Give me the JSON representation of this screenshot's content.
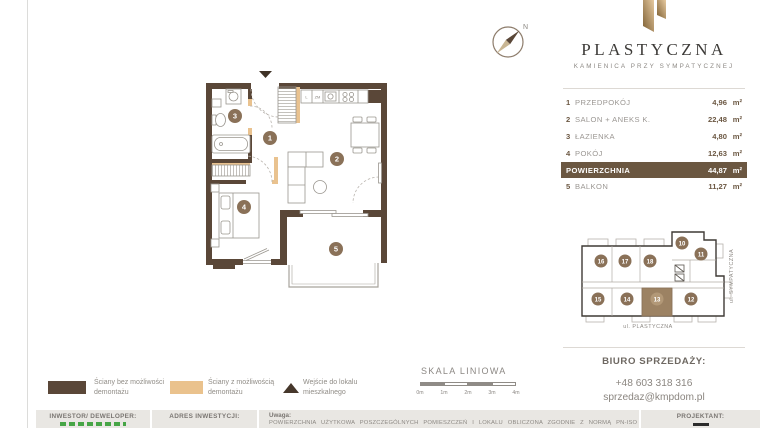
{
  "brand": {
    "title": "PLASTYCZNA",
    "subtitle": "KAMIENICA PRZY SYMPATYCZNEJ"
  },
  "compass": {
    "north_label": "N"
  },
  "floorplan": {
    "numbers": [
      "1",
      "2",
      "3",
      "4",
      "5"
    ],
    "kitchen": {
      "fridge_label": "L",
      "dishwasher_label": "ZM"
    }
  },
  "rooms": {
    "rows": [
      {
        "num": "1",
        "label": "PRZEDPOKÓJ",
        "value": "4,96",
        "unit": "m²"
      },
      {
        "num": "2",
        "label": "SALON + ANEKS K.",
        "value": "22,48",
        "unit": "m²"
      },
      {
        "num": "3",
        "label": "ŁAZIENKA",
        "value": "4,80",
        "unit": "m²"
      },
      {
        "num": "4",
        "label": "POKÓJ",
        "value": "12,63",
        "unit": "m²"
      },
      {
        "num": "",
        "label": "POWIERZCHNIA",
        "value": "44,87",
        "unit": "m²"
      },
      {
        "num": "5",
        "label": "BALKON",
        "value": "11,27",
        "unit": "m²"
      }
    ]
  },
  "miniplan": {
    "units": [
      "16",
      "17",
      "18",
      "10",
      "11",
      "15",
      "14",
      "13",
      "12"
    ],
    "highlighted_unit": "13",
    "street_bottom": "ul. PLASTYCZNA",
    "street_right": "ul. SYMPATYCZNA"
  },
  "legend": {
    "items": [
      {
        "label": "Ściany bez możliwości demontażu",
        "swatch": "dark-wall"
      },
      {
        "label": "Ściany z możliwością demontażu",
        "swatch": "light-wall"
      },
      {
        "label": "Wejście do lokalu mieszkalnego",
        "swatch": "entrance-triangle"
      }
    ]
  },
  "scalebar": {
    "title": "SKALA LINIOWA",
    "ticks": [
      "0m",
      "1m",
      "2m",
      "3m",
      "4m"
    ]
  },
  "contact": {
    "heading": "BIURO SPRZEDAŻY:",
    "phone": "+48 603 318 316",
    "email": "sprzedaz@kmpdom.pl"
  },
  "footer": {
    "investor_label": "INWESTOR/ DEWELOPER:",
    "address_label": "ADRES INWESTYCJI:",
    "notes_label": "Uwaga:",
    "notes_text": "POWIERZCHNIA UŻYTKOWA POSZCZEGÓLNYCH POMIESZCZEŃ I LOKALU OBLICZONA ZGODNIE Z NORMĄ PN-ISO",
    "designer_label": "PROJEKTANT:"
  },
  "colors": {
    "wall_dark": "#5a4738",
    "wall_light": "#e9c28f",
    "accent_brown": "#6b5741",
    "logo_gold": "#c7a065"
  }
}
